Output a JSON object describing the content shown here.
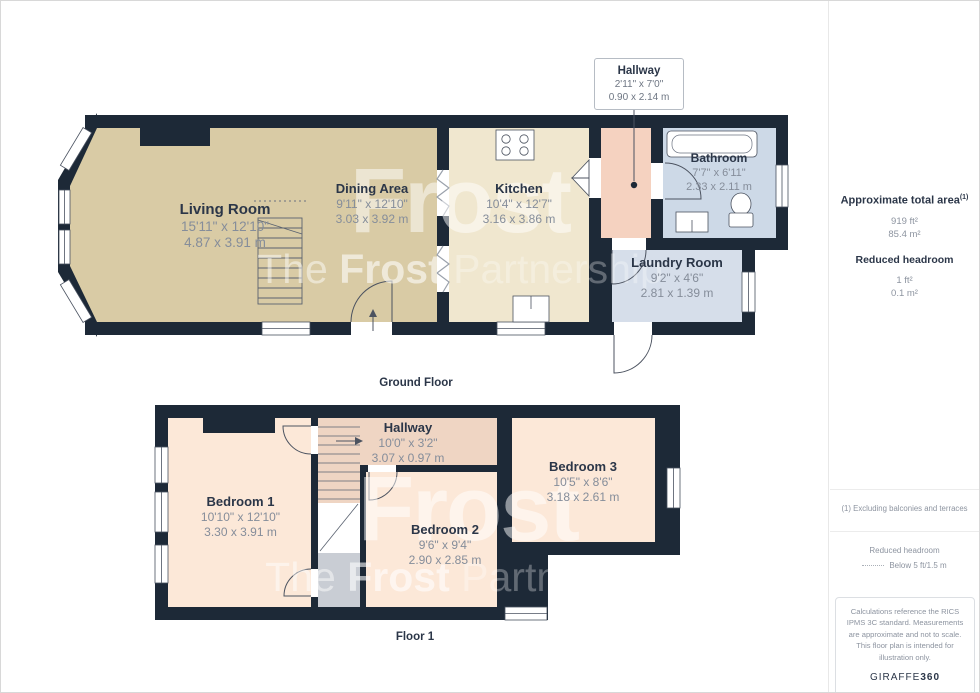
{
  "callout": {
    "name": "Hallway",
    "imperial": "2'11\" x 7'0\"",
    "metric": "0.90 x 2.14 m"
  },
  "ground_floor": {
    "label": "Ground Floor",
    "rooms": {
      "living": {
        "name": "Living Room",
        "imperial": "15'11\" x 12'10\"",
        "metric": "4.87 x 3.91 m"
      },
      "dining": {
        "name": "Dining Area",
        "imperial": "9'11\" x 12'10\"",
        "metric": "3.03 x 3.92 m"
      },
      "kitchen": {
        "name": "Kitchen",
        "imperial": "10'4\" x 12'7\"",
        "metric": "3.16 x 3.86 m"
      },
      "bathroom": {
        "name": "Bathroom",
        "imperial": "7'7\" x 6'11\"",
        "metric": "2.33 x 2.11 m"
      },
      "laundry": {
        "name": "Laundry Room",
        "imperial": "9'2\" x 4'6\"",
        "metric": "2.81 x 1.39 m"
      }
    }
  },
  "floor_1": {
    "label": "Floor 1",
    "rooms": {
      "bedroom1": {
        "name": "Bedroom 1",
        "imperial": "10'10\" x 12'10\"",
        "metric": "3.30 x 3.91 m"
      },
      "hallway": {
        "name": "Hallway",
        "imperial": "10'0\" x 3'2\"",
        "metric": "3.07 x 0.97 m"
      },
      "bedroom2": {
        "name": "Bedroom 2",
        "imperial": "9'6\" x 9'4\"",
        "metric": "2.90 x 2.85 m"
      },
      "bedroom3": {
        "name": "Bedroom 3",
        "imperial": "10'5\" x 8'6\"",
        "metric": "3.18 x 2.61 m"
      }
    }
  },
  "sidebar": {
    "total_area": {
      "title": "Approximate total area",
      "footnote_marker": "(1)",
      "imperial": "919 ft²",
      "metric": "85.4 m²"
    },
    "reduced_headroom": {
      "title": "Reduced headroom",
      "imperial": "1 ft²",
      "metric": "0.1 m²"
    },
    "footnote": "(1) Excluding balconies and terraces",
    "legend": {
      "title": "Reduced headroom",
      "value": "Below 5 ft/1.5 m"
    },
    "disclaimer": "Calculations reference the RICS IPMS 3C standard. Measurements are approximate and not to scale. This floor plan is intended for illustration only.",
    "brand": {
      "name": "GIRAFFE",
      "suffix": "360"
    }
  },
  "watermark": {
    "line1": "Frost",
    "the": "The",
    "brand": "Frost",
    "partnership": "Partnership"
  },
  "colors": {
    "wall": "#1d2937",
    "living_dining": "#d9cba5",
    "kitchen": "#f0e7cf",
    "hallway_ground": "#f5d2c0",
    "bathroom": "#cdd9e7",
    "laundry": "#d6deea",
    "bedroom": "#fce8d8",
    "hallway_floor1": "#efd5c3",
    "stairs_landing": "#c9cdd4"
  }
}
